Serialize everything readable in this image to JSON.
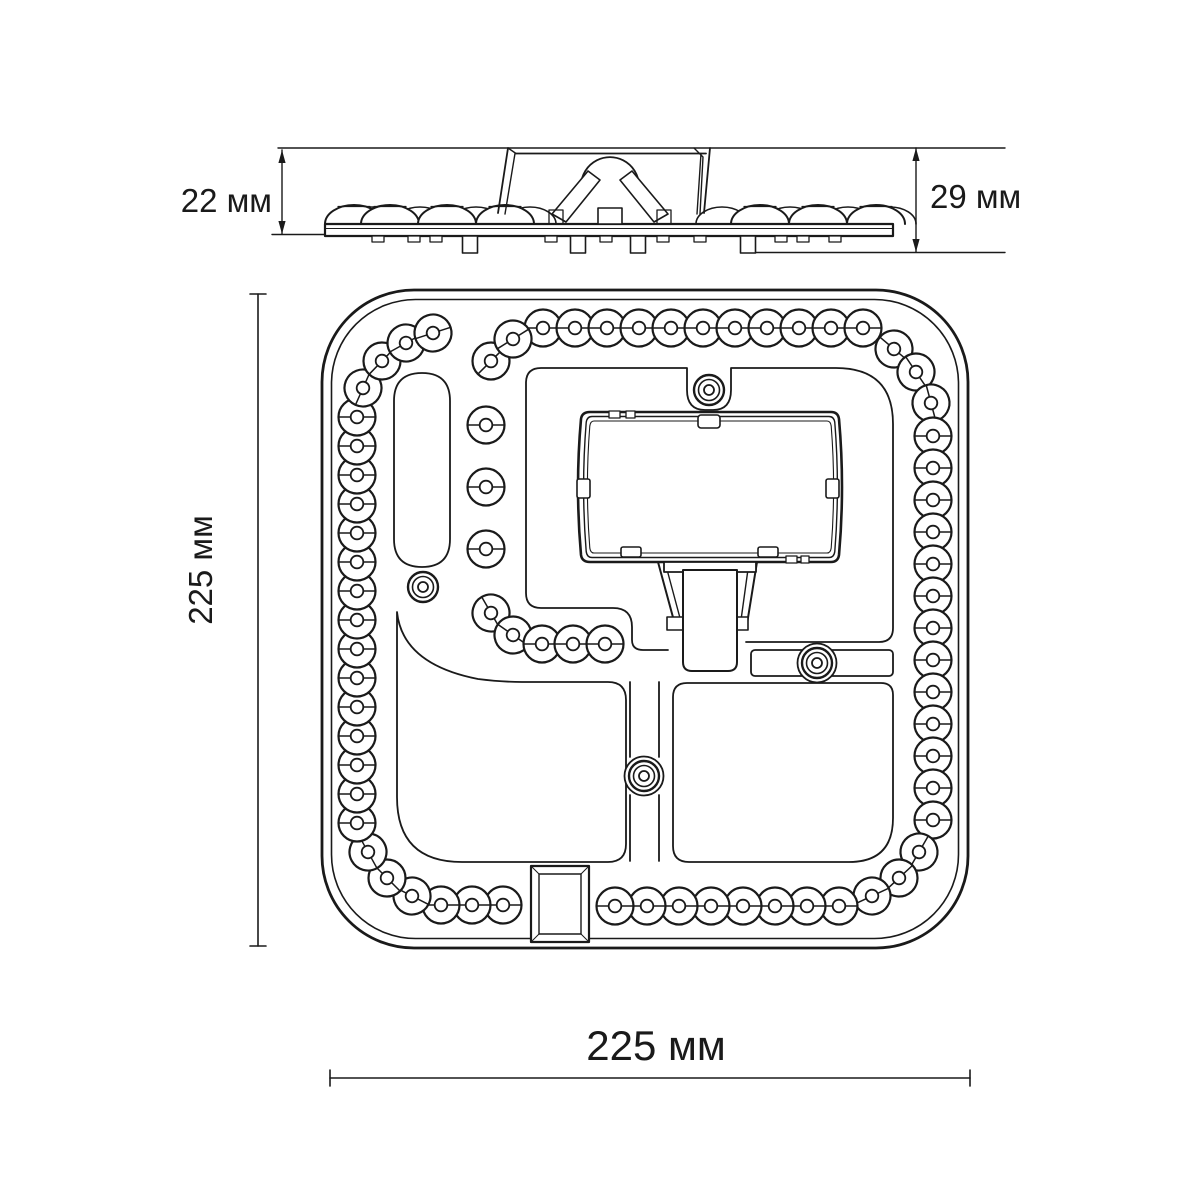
{
  "colors": {
    "background": "#ffffff",
    "line": "#1a1a1a"
  },
  "labels": {
    "side_view_left": "22 мм",
    "side_view_right": "29 мм",
    "top_view_vertical": "225 мм",
    "top_view_horizontal": "225 мм"
  },
  "side_view": {
    "front_lens_x": [
      354,
      390,
      447,
      505,
      760,
      818,
      876
    ],
    "back_lens_x": [
      372,
      420,
      476,
      530,
      722,
      790,
      848,
      890
    ],
    "pins_x": [
      470,
      578,
      638,
      748
    ],
    "nubs_x": [
      378,
      414,
      436,
      551,
      606,
      663,
      700,
      781,
      803,
      835
    ]
  },
  "top_view": {
    "led_outer_r": 18.5,
    "led_inner_r": 6.3,
    "leds": [
      [
        543,
        328,
        0
      ],
      [
        575,
        328,
        0
      ],
      [
        607,
        328,
        0
      ],
      [
        639,
        328,
        0
      ],
      [
        671,
        328,
        0
      ],
      [
        703,
        328,
        0
      ],
      [
        735,
        328,
        0
      ],
      [
        767,
        328,
        0
      ],
      [
        799,
        328,
        0
      ],
      [
        831,
        328,
        0
      ],
      [
        863,
        328,
        0
      ],
      [
        894,
        349,
        40
      ],
      [
        916,
        372,
        56
      ],
      [
        931,
        403,
        75
      ],
      [
        933,
        436,
        0
      ],
      [
        933,
        468,
        0
      ],
      [
        933,
        500,
        0
      ],
      [
        933,
        532,
        0
      ],
      [
        933,
        564,
        0
      ],
      [
        933,
        596,
        0
      ],
      [
        933,
        628,
        0
      ],
      [
        933,
        660,
        0
      ],
      [
        933,
        692,
        0
      ],
      [
        933,
        724,
        0
      ],
      [
        933,
        756,
        0
      ],
      [
        933,
        788,
        0
      ],
      [
        933,
        820,
        0
      ],
      [
        919,
        852,
        -60
      ],
      [
        899,
        878,
        -43
      ],
      [
        872,
        896,
        -25
      ],
      [
        839,
        906,
        0
      ],
      [
        807,
        906,
        0
      ],
      [
        775,
        906,
        0
      ],
      [
        743,
        906,
        0
      ],
      [
        711,
        906,
        0
      ],
      [
        679,
        906,
        0
      ],
      [
        647,
        906,
        0
      ],
      [
        615,
        906,
        0
      ],
      [
        503,
        905,
        0
      ],
      [
        472,
        905,
        0
      ],
      [
        441,
        905,
        0
      ],
      [
        412,
        896,
        27
      ],
      [
        387,
        878,
        45
      ],
      [
        368,
        852,
        61
      ],
      [
        357,
        823,
        0
      ],
      [
        357,
        794,
        0
      ],
      [
        357,
        765,
        0
      ],
      [
        357,
        736,
        0
      ],
      [
        357,
        707,
        0
      ],
      [
        357,
        678,
        0
      ],
      [
        357,
        649,
        0
      ],
      [
        357,
        620,
        0
      ],
      [
        357,
        591,
        0
      ],
      [
        357,
        562,
        0
      ],
      [
        357,
        533,
        0
      ],
      [
        357,
        504,
        0
      ],
      [
        357,
        475,
        0
      ],
      [
        357,
        446,
        0
      ],
      [
        357,
        417,
        0
      ],
      [
        363,
        388,
        -66
      ],
      [
        382,
        361,
        -46
      ],
      [
        406,
        343,
        -29
      ],
      [
        433,
        333,
        -18
      ],
      [
        491,
        361,
        -45
      ],
      [
        513,
        339,
        -32
      ],
      [
        486,
        425,
        0
      ],
      [
        486,
        487,
        0
      ],
      [
        486,
        549,
        0
      ],
      [
        491,
        613,
        60
      ],
      [
        513,
        635,
        35
      ],
      [
        542,
        644,
        0
      ],
      [
        573,
        644,
        0
      ],
      [
        605,
        644,
        0
      ]
    ],
    "screws": [
      {
        "x": 709,
        "y": 390,
        "boss": false
      },
      {
        "x": 423,
        "y": 587,
        "boss": false
      },
      {
        "x": 817,
        "y": 663,
        "boss": true
      },
      {
        "x": 644,
        "y": 776,
        "boss": true
      }
    ]
  }
}
